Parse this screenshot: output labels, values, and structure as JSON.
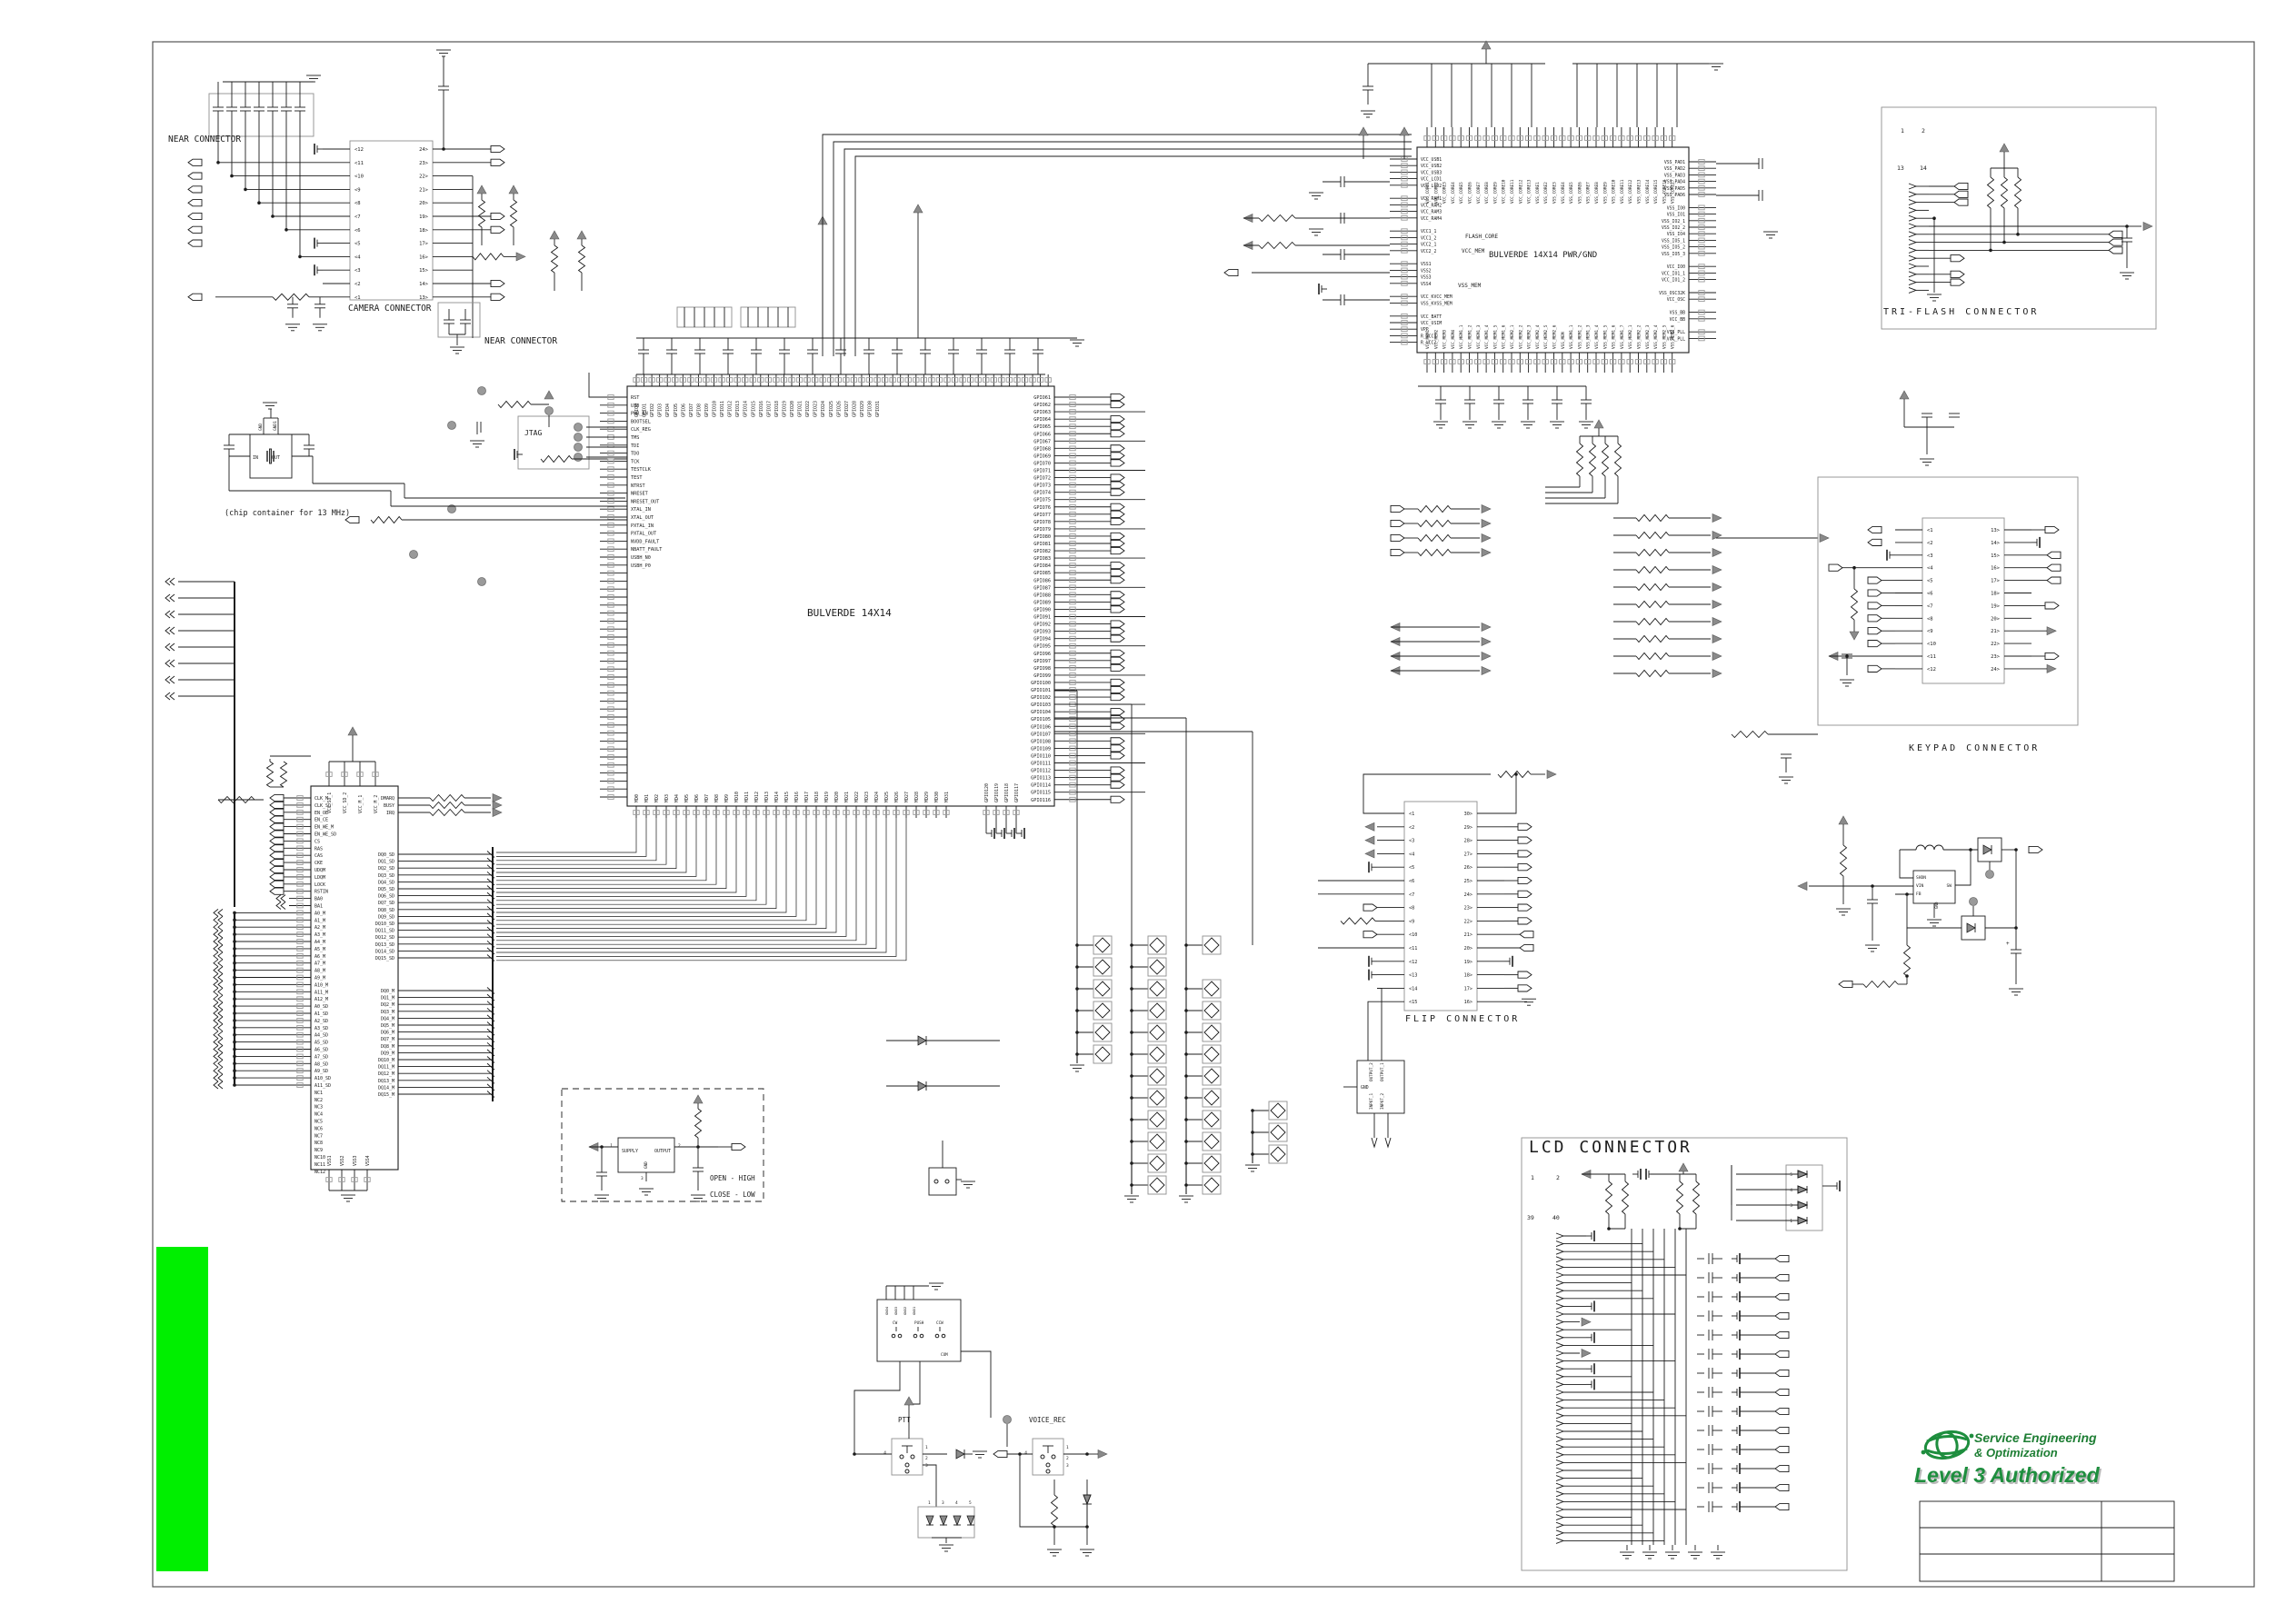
{
  "colors": {
    "line": "#1c1c1c",
    "gray": "#8f8f8f",
    "green_bar": "#00ef00",
    "logo_green": "#1e7e34"
  },
  "titles": {
    "near_connector_1": "NEAR CONNECTOR",
    "camera_connector": "CAMERA CONNECTOR",
    "near_connector_2": "NEAR CONNECTOR",
    "osc_note": "(chip container for 13 MHz)",
    "jtag": "JTAG",
    "main_chip": "BULVERDE 14X14",
    "pwr_chip": "BULVERDE 14X14 PWR/GND",
    "tri_flash": "TRI-FLASH CONNECTOR",
    "keypad": "KEYPAD CONNECTOR",
    "flip": "FLIP CONNECTOR",
    "lcd": "LCD CONNECTOR",
    "ptt": "PTT",
    "voice_rec": "VOICE_REC",
    "open_high": "OPEN - HIGH",
    "close_low": "CLOSE - LOW"
  },
  "camera": {
    "left": {
      "prefix": "<",
      "from": 12,
      "to": 1
    },
    "right": {
      "from": 24,
      "to": 13,
      "suffix": ">"
    }
  },
  "keypad": {
    "left": {
      "prefix": "<",
      "from": 1,
      "to": 12
    },
    "right": {
      "from": 13,
      "to": 24,
      "suffix": ">"
    }
  },
  "flip": {
    "left": {
      "prefix": "<",
      "from": 1,
      "to": 15
    },
    "right": {
      "from": 30,
      "to": 16,
      "suffix": ">"
    }
  },
  "chips": {
    "main": {
      "left": [
        "RST",
        "UIO",
        "PWR_EN",
        "BOOTSEL",
        "CLK_REG",
        "TMS",
        "TDI",
        "TDO",
        "TCK",
        "TESTCLK",
        "TEST",
        "NTRST",
        "NRESET",
        "NRESET_OUT",
        "XTAL_IN",
        "XTAL_OUT",
        "PXTAL_IN",
        "PXTAL_OUT",
        "NVDD_FAULT",
        "NBATT_FAULT",
        "USBH_N0",
        "USBH_P0"
      ],
      "right": {
        "prefix": "GPIO",
        "from": 61,
        "to": 116
      },
      "top": {
        "prefix": "GPIO",
        "from": 0,
        "to": 31
      },
      "bottom": {
        "prefix": "MD",
        "from": 0,
        "to": 31
      },
      "bottom2": {
        "prefix": "GPIO",
        "from": 120,
        "to": 117
      }
    },
    "pwr": {
      "left": [
        "VCC_USB1",
        "VCC_USB2",
        "VCC_USB3",
        "VCC_LCD1",
        "VCC_LCD2",
        "",
        "VCC_RAM1",
        "VCC_RAM2",
        "VCC_RAM3",
        "VCC_RAM4",
        "",
        "VCC1_1",
        "VCC1_2",
        "VCC2_1",
        "VCC2_2",
        "",
        "VSS1",
        "VSS2",
        "VSS3",
        "VSS4",
        "",
        "VCC_KVCC_MEM",
        "VSS_KVSS_MEM",
        "",
        "VCC_BATT",
        "VCC_USIM",
        "VPP",
        "R_VCC1",
        "R_VCC2"
      ],
      "right": [
        "VSS_PAD1",
        "VSS_PAD2",
        "VSS_PAD3",
        "VSS_PAD4",
        "VSS_PAD5",
        "VSS_PAD6",
        "",
        "VSS_IO0",
        "VSS_IO1",
        "VSS_IO2_1",
        "VSS_IO2_2",
        "VSS_IO4",
        "VSS_IO5_1",
        "VSS_IO5_2",
        "VSS_IO5_3",
        "",
        "VCC_IO0",
        "VCC_IO1_1",
        "VCC_IO1_2",
        "",
        "VSS_OSC32K",
        "VCC_OSC",
        "",
        "VSS_BB",
        "VCC_BB",
        "",
        "VSS_PLL",
        "VCC_PLL"
      ],
      "top_vcc": {
        "prefix": "VCC_CORE",
        "from": 1,
        "to": 13
      },
      "top_vss": {
        "prefix": "VSS_CORE",
        "from": 1,
        "to": 17
      },
      "bottom_left": [
        "VCC_MEM1",
        "VCC_MEM2",
        "VCC_MEM3",
        "VCC_MEM4",
        "VCC_MEM1_1",
        "VCC_MEM1_2",
        "VCC_MEM1_3",
        "VCC_MEM1_4",
        "VCC_MEM1_5",
        "VCC_MEM1_6",
        "VCC_MEM2_1",
        "VCC_MEM2_2",
        "VCC_MEM2_3",
        "VCC_MEM2_4",
        "VCC_MEM2_5",
        "VCC_MEM2_6"
      ],
      "bottom_right": [
        "VSS_MEM",
        "VSS_MEM1_1",
        "VSS_MEM1_2",
        "VSS_MEM1_3",
        "VSS_MEM1_4",
        "VSS_MEM1_5",
        "VSS_MEM1_6",
        "VSS_MEM1_7",
        "VSS_MEM2_1",
        "VSS_MEM2_2",
        "VSS_MEM2_3",
        "VSS_MEM2_4",
        "VSS_MEM2_5",
        "VSS_MEM2_6"
      ],
      "groups": [
        "FLASH_CORE",
        "VCC_MEM",
        "VSS_MEM"
      ]
    },
    "mem": {
      "ctrl": [
        "CLK_M",
        "CLK_SD",
        "EN_OE",
        "EN_CE",
        "EN_WE_M",
        "EN_WE_SD",
        "CS",
        "RAS",
        "CAS",
        "CKE",
        "UDQM",
        "LDQM",
        "LOCK",
        "RSTIN",
        "BA0",
        "BA1"
      ],
      "addr_m": {
        "prefix": "A",
        "from": 0,
        "to": 12,
        "suffix": "_M"
      },
      "addr_sd": {
        "prefix": "A",
        "from": 0,
        "to": 11,
        "suffix": "_SD"
      },
      "nc": {
        "prefix": "NC",
        "from": 1,
        "to": 12
      },
      "top": [
        "VCC_SD_1",
        "VCC_SD_2",
        "VCC_M_1",
        "VCC_M_2"
      ],
      "bottom": {
        "prefix": "VSS",
        "from": 1,
        "to": 4
      },
      "right_ctrl": [
        "DMARQ",
        "BUSY",
        "IRQ"
      ],
      "dq_sd": {
        "prefix": "DQ",
        "from": 0,
        "to": 15,
        "suffix": "_SD"
      },
      "dq_m": {
        "prefix": "DQ",
        "from": 0,
        "to": 15,
        "suffix": "_M"
      }
    }
  },
  "dcdc": {
    "pins": [
      "SHDN",
      "VIN",
      "FB",
      "GND",
      "SW"
    ]
  },
  "buffer": {
    "pins": [
      "GND",
      "INPUT_1",
      "INPUT_2",
      "OUTPUT_1",
      "OUTPUT_2"
    ]
  },
  "osc": {
    "pins": [
      "IN",
      "OUT",
      "GND",
      "GND1"
    ]
  },
  "hall": {
    "pins": [
      "SUPPLY",
      "OUTPUT",
      "GND"
    ],
    "pin_nums": [
      "1",
      "2",
      "3"
    ]
  },
  "jog": {
    "switches": [
      "CW",
      "PUSH",
      "CCW"
    ],
    "gnds": [
      "GND4",
      "GND3",
      "GND2",
      "GND1"
    ],
    "com": "COM"
  },
  "numbers": {
    "triflash": [
      "1",
      "2",
      "13",
      "14"
    ],
    "lcd": [
      "1",
      "2",
      "39",
      "40"
    ],
    "diode_pack": [
      "5",
      "4",
      "3",
      "1"
    ],
    "ptt_diodes": [
      "1",
      "3",
      "4",
      "5"
    ],
    "generic": [
      "1",
      "2",
      "3",
      "4"
    ]
  },
  "logo": {
    "line1": "Service Engineering",
    "line2": "& Optimization",
    "line3": "Level 3 Authorized"
  }
}
